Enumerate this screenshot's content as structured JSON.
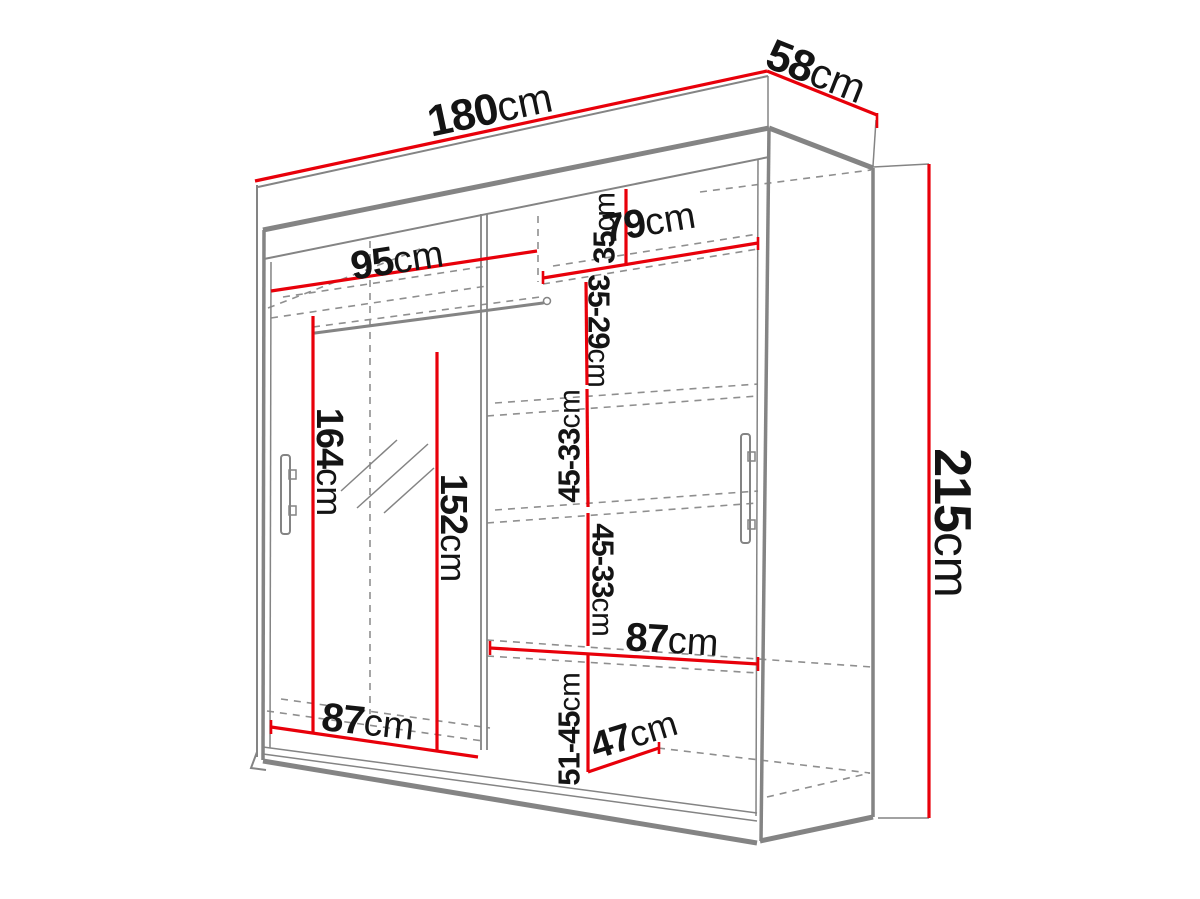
{
  "colors": {
    "red": "#e8000a",
    "gray": "#848484",
    "dash_gray": "#8f8f8f",
    "ink": "#141414",
    "bg": "#ffffff"
  },
  "diagram_title": "",
  "labels": [
    {
      "id": "width-total",
      "value": "180",
      "unit": "cm",
      "x": 490,
      "y": 110,
      "rot": -12,
      "size": 44
    },
    {
      "id": "depth-total",
      "value": "58",
      "unit": "cm",
      "x": 816,
      "y": 72,
      "rot": 21.5,
      "size": 44
    },
    {
      "id": "height-total",
      "value": "215",
      "unit": "cm",
      "x": 952,
      "y": 523,
      "rot": 90,
      "size": 52
    },
    {
      "id": "shelf-width-left-top",
      "value": "95",
      "unit": "cm",
      "x": 397,
      "y": 260,
      "rot": -8.5,
      "size": 40
    },
    {
      "id": "shelf-width-right-top",
      "value": "79",
      "unit": "cm",
      "x": 649,
      "y": 222,
      "rot": -9.5,
      "size": 40
    },
    {
      "id": "gap-right-top",
      "value": "35",
      "unit": "cm",
      "x": 604,
      "y": 228,
      "rot": -90,
      "size": 31
    },
    {
      "id": "gap-right-2",
      "value": "35-29",
      "unit": "cm",
      "x": 599,
      "y": 331,
      "rot": 90,
      "size": 31
    },
    {
      "id": "gap-right-3",
      "value": "45-33",
      "unit": "cm",
      "x": 569,
      "y": 446,
      "rot": -90,
      "size": 31
    },
    {
      "id": "gap-right-4",
      "value": "45-33",
      "unit": "cm",
      "x": 603,
      "y": 580,
      "rot": 90,
      "size": 31
    },
    {
      "id": "gap-right-bottom",
      "value": "51-45",
      "unit": "cm",
      "x": 569,
      "y": 729,
      "rot": -90,
      "size": 31
    },
    {
      "id": "hanging-height-left",
      "value": "164",
      "unit": "cm",
      "x": 329,
      "y": 462,
      "rot": 90,
      "size": 38
    },
    {
      "id": "mirror-height",
      "value": "152",
      "unit": "cm",
      "x": 453,
      "y": 528,
      "rot": 90,
      "size": 38
    },
    {
      "id": "bottom-width-left",
      "value": "87",
      "unit": "cm",
      "x": 368,
      "y": 722,
      "rot": 6,
      "size": 40
    },
    {
      "id": "shelf-width-right-low",
      "value": "87",
      "unit": "cm",
      "x": 672,
      "y": 640,
      "rot": 3.5,
      "size": 40
    },
    {
      "id": "depth-bottom-right",
      "value": "47",
      "unit": "cm",
      "x": 634,
      "y": 735,
      "rot": -17,
      "size": 38
    }
  ]
}
